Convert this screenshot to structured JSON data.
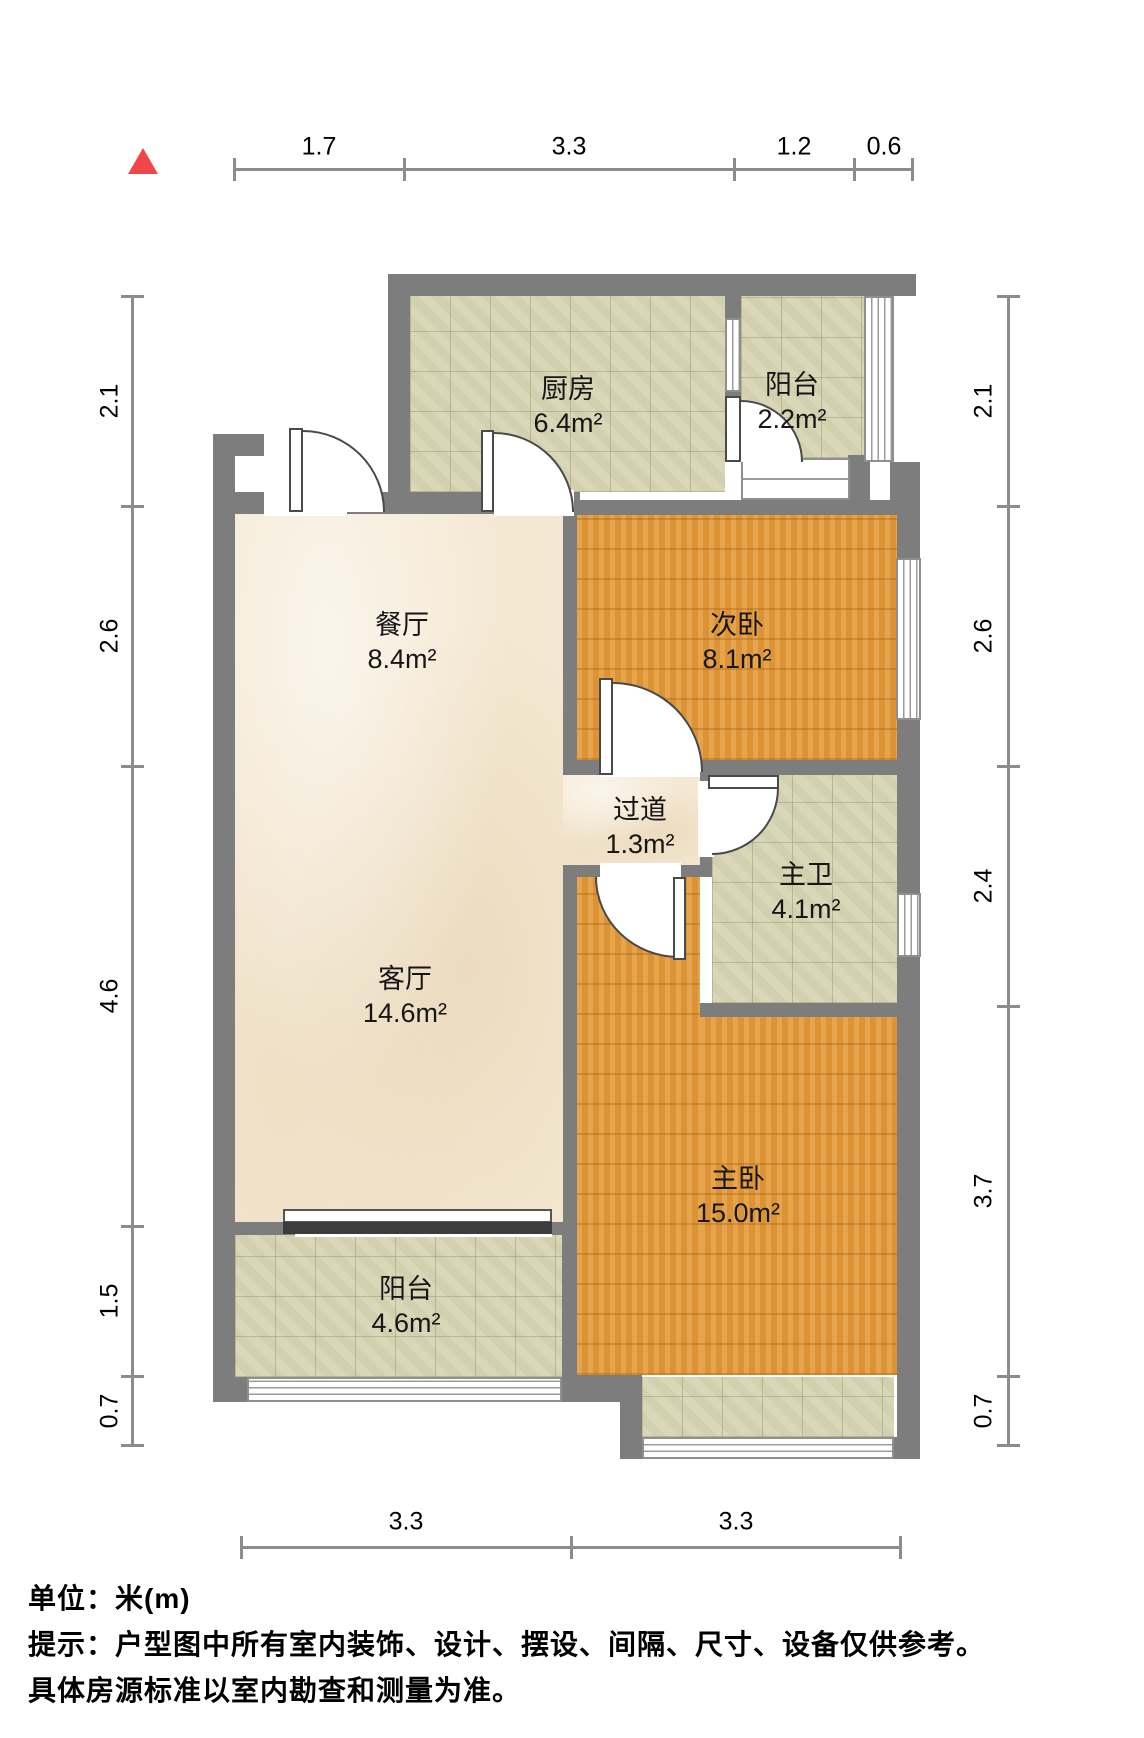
{
  "title": "户型图",
  "north_indicator": "north-triangle",
  "rooms": [
    {
      "id": "kitchen",
      "name": "厨房",
      "area": "6.4m²"
    },
    {
      "id": "balcony-top",
      "name": "阳台",
      "area": "2.2m²"
    },
    {
      "id": "dining",
      "name": "餐厅",
      "area": "8.4m²"
    },
    {
      "id": "bedroom-second",
      "name": "次卧",
      "area": "8.1m²"
    },
    {
      "id": "hallway",
      "name": "过道",
      "area": "1.3m²"
    },
    {
      "id": "bath-master",
      "name": "主卫",
      "area": "4.1m²"
    },
    {
      "id": "living",
      "name": "客厅",
      "area": "14.6m²"
    },
    {
      "id": "bedroom-master",
      "name": "主卧",
      "area": "15.0m²"
    },
    {
      "id": "balcony-bottom",
      "name": "阳台",
      "area": "4.6m²"
    }
  ],
  "dimensions": {
    "top": [
      "1.7",
      "3.3",
      "1.2",
      "0.6"
    ],
    "left": [
      "2.1",
      "2.6",
      "4.6",
      "1.5",
      "0.7"
    ],
    "right": [
      "2.1",
      "2.6",
      "2.4",
      "3.7",
      "0.7"
    ],
    "bottom": [
      "3.3",
      "3.3"
    ]
  },
  "footer": {
    "unit_line": "单位：米(m)",
    "tip_line": "提示：户型图中所有室内装饰、设计、摆设、间隔、尺寸、设备仅供参考。",
    "tip_line2": "具体房源标准以室内勘查和测量为准。"
  },
  "colors": {
    "wall": "#7d7d7d",
    "floor_tile": "#d8d5b4",
    "floor_marble": "#f4e8d2",
    "floor_wood": "#e2993b",
    "north_arrow": "#ef4747",
    "dimension_line": "#8c8c8c"
  }
}
